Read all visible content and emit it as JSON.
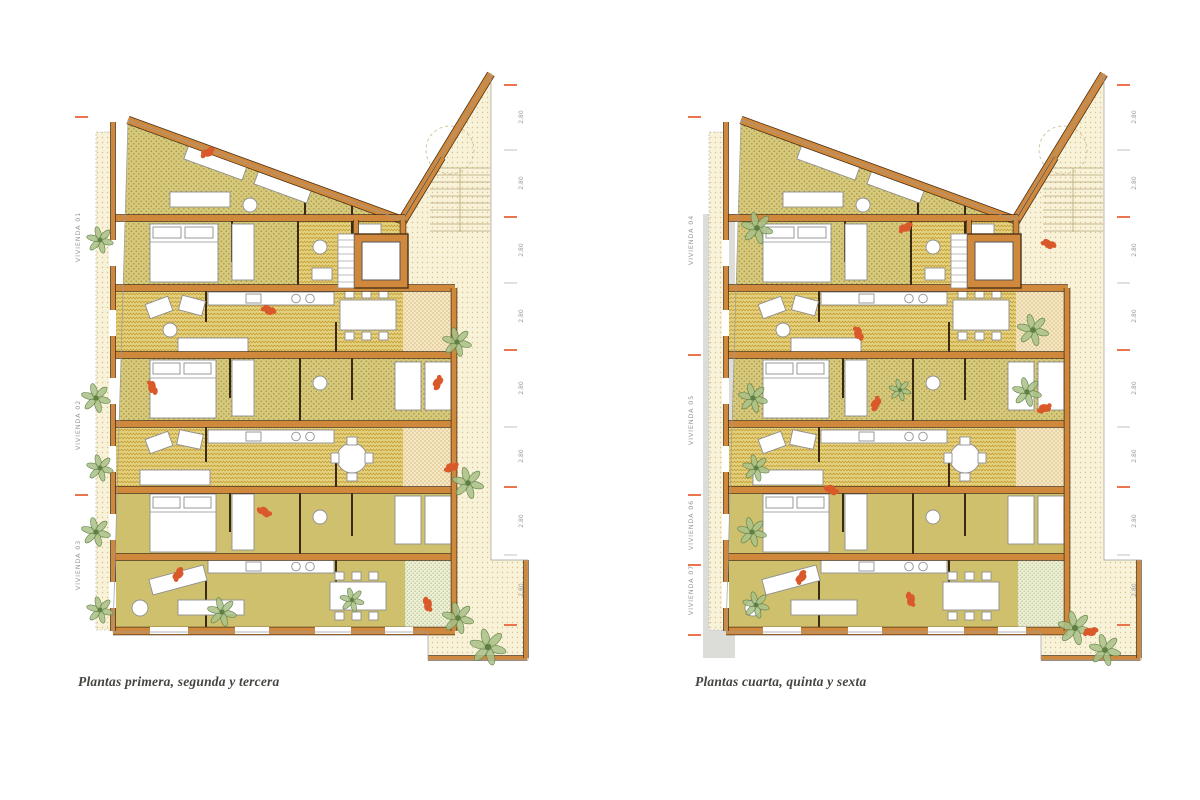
{
  "sheet": {
    "background": "#ffffff"
  },
  "plans": [
    {
      "name": "plantas-1-2-3",
      "caption": "Plantas primera, segunda y tercera",
      "viviendas": [
        "VIVIENDA 01",
        "VIVIENDA 02",
        "VIVIENDA 03"
      ],
      "dim_labels": [
        "2.80",
        "2.80",
        "2.80",
        "2.80",
        "2.80",
        "2.80",
        "2.80",
        "2.80"
      ]
    },
    {
      "name": "plantas-4-5-6",
      "caption": "Plantas cuarta, quinta y sexta",
      "viviendas": [
        "VIVIENDA 04",
        "VIVIENDA 05",
        "VIVIENDA 06",
        "VIVIENDA 07"
      ],
      "dim_labels": [
        "2.80",
        "2.80",
        "2.80",
        "2.80",
        "2.80",
        "2.80",
        "2.80",
        "2.80"
      ]
    }
  ],
  "colors": {
    "wall": "#d0883d",
    "wall_dark": "#4a3318",
    "room_base": "#d6c97b",
    "room_dot": "#a8984a",
    "room_zig_bg": "#e3d382",
    "room_zig": "#c89f35",
    "room_plain": "#cfc06e",
    "patio_bg": "#f8f2d9",
    "patio_dot": "#d9bf8e",
    "terrace_bg": "#f4e9c6",
    "terrace_dot": "#d8ae6e",
    "green_bg": "#edefd6",
    "green_dot": "#b7c28c",
    "figure": "#d9592b",
    "tick_orange": "#e8663c",
    "tick_gray": "#c6c6c6",
    "plant": "#a9c187",
    "plant_dark": "#5f7f45",
    "furniture_stroke": "#8f8f8f",
    "label": "#9a9a9a",
    "caption": "#45443f",
    "shadow": "#dcdcd8",
    "stair": "#b5a678"
  }
}
